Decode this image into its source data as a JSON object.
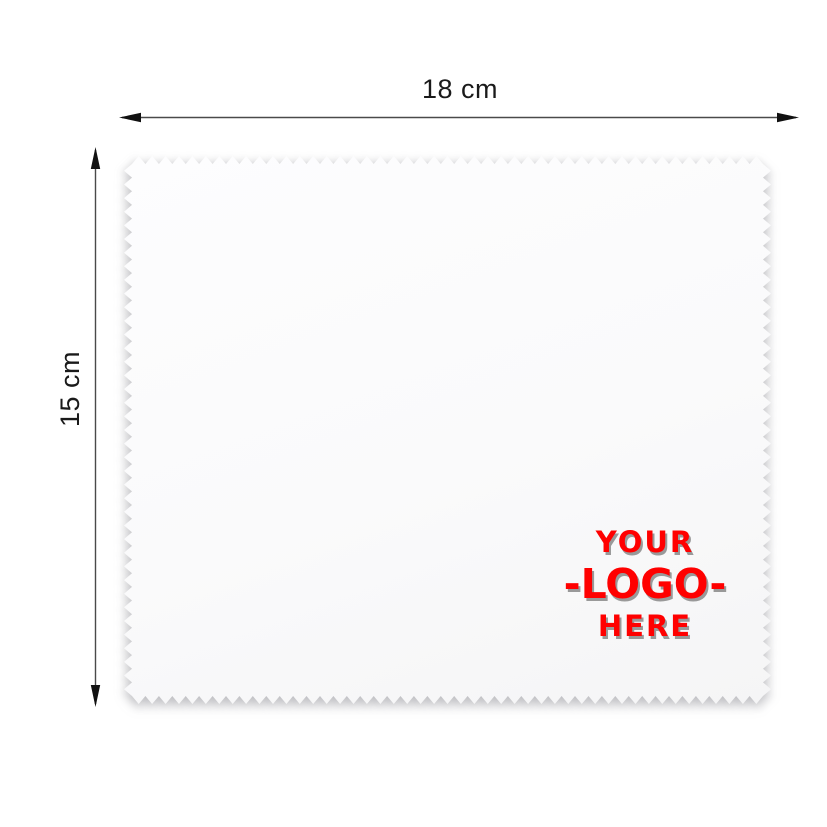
{
  "annotations": {
    "width_dimension": {
      "label": "18 cm"
    },
    "height_dimension": {
      "label": "15 cm"
    },
    "arrow_color": "#111111",
    "line_color": "#4a4a4a",
    "label_color": "#1a1a1a"
  },
  "cloth": {
    "fill_color": "#fafafb",
    "edge_style": "zigzag",
    "logo_placeholder": {
      "line1": "YOUR",
      "line2": "-LOGO-",
      "line3": "HERE",
      "text_color": "#ff0000",
      "shadow_color": "#999999"
    }
  }
}
